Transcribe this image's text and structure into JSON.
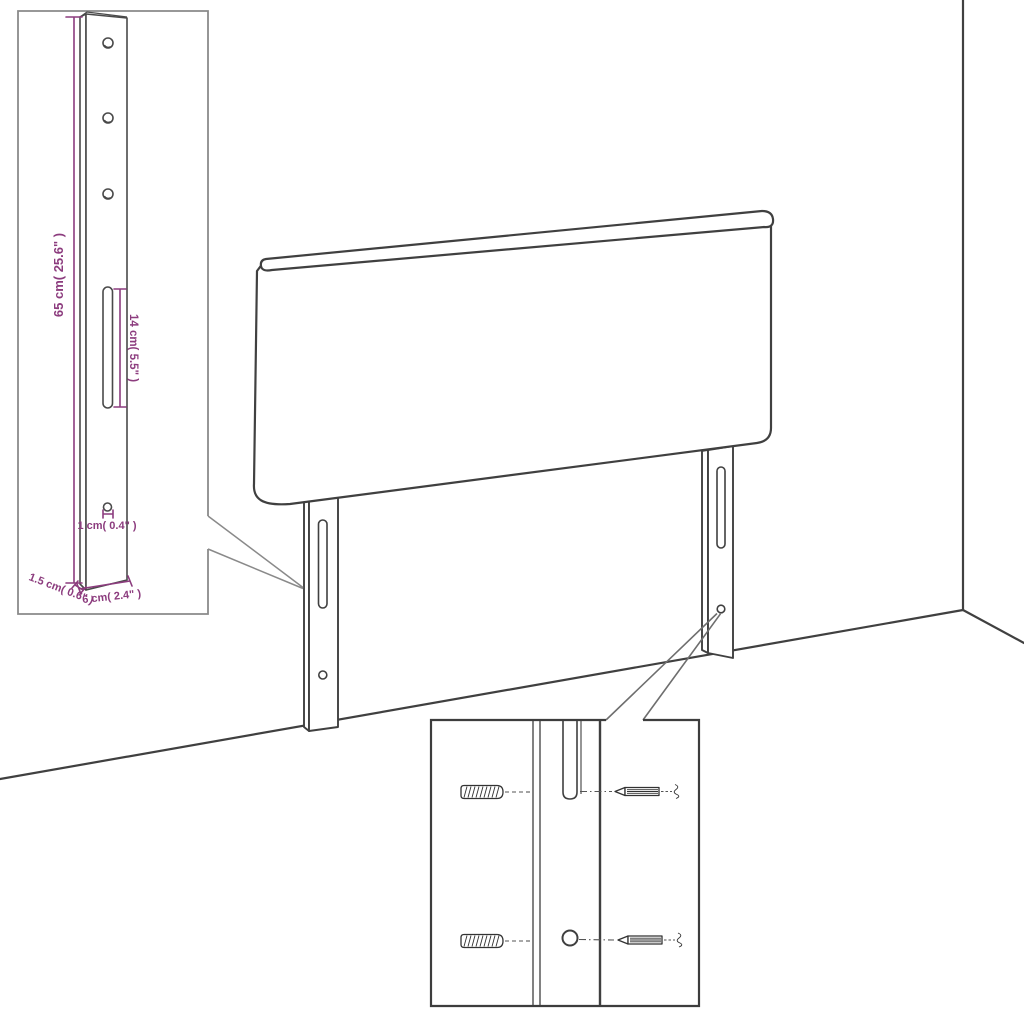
{
  "diagram": {
    "subject": "headboard assembly dimension drawing with detail insets",
    "measurements": {
      "height": "65 cm( 25.6\" )",
      "slot_length": "14 cm( 5.5\" )",
      "hole_diameter": "1 cm( 0.4\" )",
      "leg_thickness": "1.5 cm( 0.6\" )",
      "leg_width": "6 cm( 2.4\" )"
    },
    "colors": {
      "dimension_accent": "#8c3c7e",
      "line_art": "#404040",
      "inset_border_light": "#8a8a8a",
      "inset_border_dark": "#3d3d3d",
      "background": "#ffffff"
    }
  }
}
